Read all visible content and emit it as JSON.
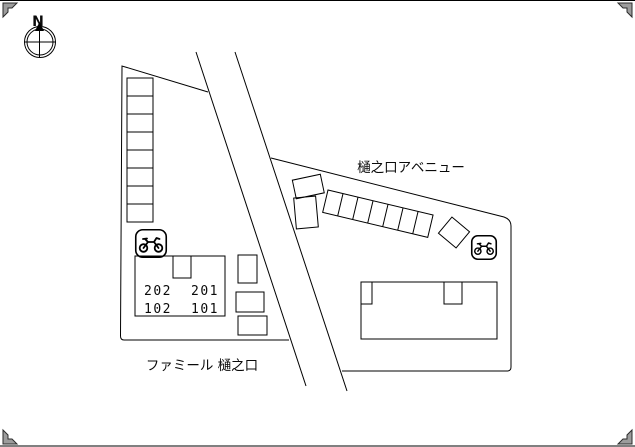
{
  "canvas": {
    "width": 635,
    "height": 447,
    "background": "#ffffff",
    "line_color": "#000000",
    "corner_mark_color": "#9c9c9c"
  },
  "compass": {
    "north_label": "N"
  },
  "road": {
    "avenue_label": "樋之口アベニュー"
  },
  "property": {
    "name_label": "ファミール 樋之口",
    "rooms": {
      "r202": "202",
      "r201": "201",
      "r102": "102",
      "r101": "101"
    }
  },
  "parking": {
    "left_column_spaces": 8,
    "diagonal_row_spaces": 7,
    "motorcycle_icon_count": 2
  }
}
